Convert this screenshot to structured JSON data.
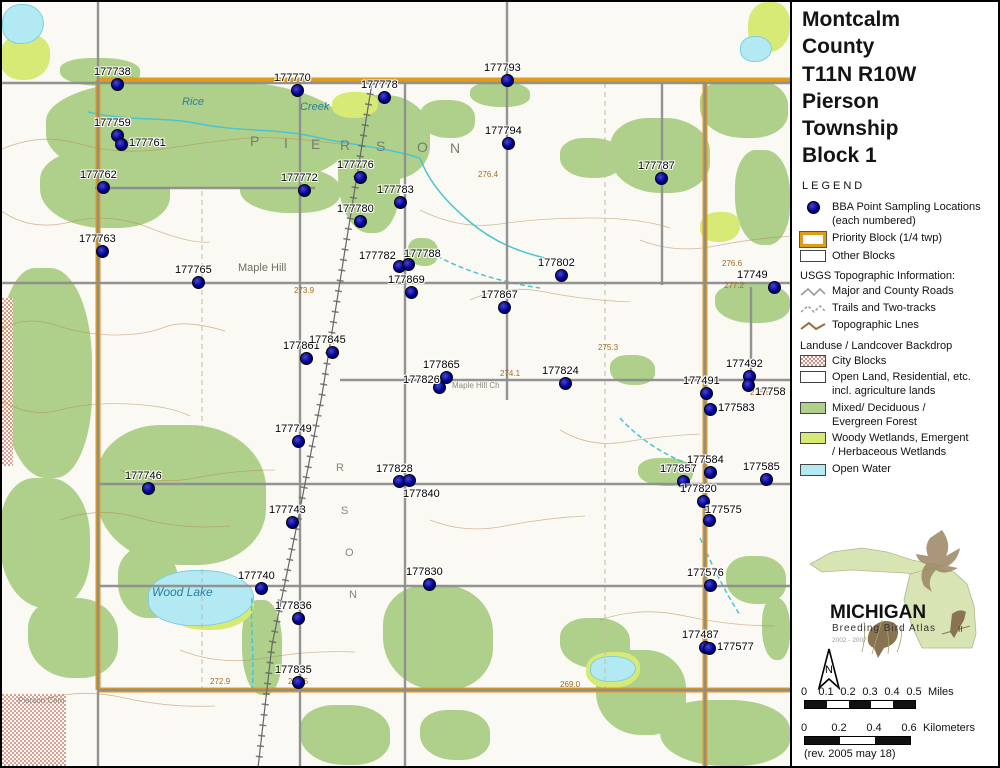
{
  "panel": {
    "title_lines": [
      "Montcalm",
      "County",
      "T11N R10W",
      "Pierson",
      "Township",
      "Block 1"
    ],
    "legend_heading": "LEGEND",
    "legend": {
      "bba_label_1": "BBA Point Sampling Locations",
      "bba_label_2": "(each numbered)",
      "priority_label": "Priority Block (1/4 twp)",
      "other_label": "Other Blocks",
      "usgs_heading": "USGS Topographic Information:",
      "roads_label": "Major and County Roads",
      "trails_label": "Trails and Two-tracks",
      "topo_label": "Topographic Lnes",
      "landuse_heading": "Landuse / Landcover Backdrop",
      "city_label": "City Blocks",
      "open_label_1": "Open Land, Residential, etc.",
      "open_label_2": "incl. agriculture lands",
      "forest_label_1": "Mixed/ Deciduous /",
      "forest_label_2": "Evergreen Forest",
      "wetland_label_1": "Woody Wetlands, Emergent",
      "wetland_label_2": "/ Herbaceous Wetlands",
      "water_label": "Open Water"
    },
    "logo": {
      "name": "MICHIGAN",
      "subtitle": "Breeding Bird Atlas",
      "numeral": "II",
      "years": "2002 - 2007"
    },
    "north_label": "N",
    "scalebars": [
      {
        "ticks": [
          "0",
          "0.1",
          "0.2",
          "0.3",
          "0.4",
          "0.5"
        ],
        "unit": "Miles",
        "segments": 5,
        "segw": 22,
        "top": 686
      },
      {
        "ticks": [
          "0",
          "0.2",
          "0.4",
          "0.6"
        ],
        "unit": "Kilometers",
        "segments": 3,
        "segw": 35,
        "top": 722
      }
    ],
    "rev_note": "(rev. 2005 may 18)"
  },
  "map": {
    "colors": {
      "forest": "#aed08a",
      "wetland": "#d7ea75",
      "water": "#b3e9f2",
      "priority": "#e09b18",
      "road": "#8d8d8d",
      "contour": "#b5854f",
      "creek": "#49c5cf",
      "point": "#000090"
    },
    "points": [
      {
        "id": "177738",
        "x": 117,
        "y": 84,
        "pos": "a"
      },
      {
        "id": "177770",
        "x": 297,
        "y": 90,
        "pos": "a"
      },
      {
        "id": "177778",
        "x": 384,
        "y": 97,
        "pos": "a"
      },
      {
        "id": "177793",
        "x": 507,
        "y": 80,
        "pos": "a"
      },
      {
        "id": "177794",
        "x": 508,
        "y": 143,
        "pos": "a"
      },
      {
        "id": "177787",
        "x": 661,
        "y": 178,
        "pos": "a"
      },
      {
        "id": "177759",
        "x": 117,
        "y": 135,
        "pos": "a"
      },
      {
        "id": "177761",
        "x": 121,
        "y": 144,
        "pos": "r"
      },
      {
        "id": "177762",
        "x": 103,
        "y": 187,
        "pos": "a"
      },
      {
        "id": "177772",
        "x": 304,
        "y": 190,
        "pos": "a"
      },
      {
        "id": "177776",
        "x": 360,
        "y": 177,
        "pos": "a"
      },
      {
        "id": "177783",
        "x": 400,
        "y": 202,
        "pos": "a"
      },
      {
        "id": "177780",
        "x": 360,
        "y": 221,
        "pos": "a"
      },
      {
        "id": "177763",
        "x": 102,
        "y": 251,
        "pos": "a"
      },
      {
        "id": "177765",
        "x": 198,
        "y": 282,
        "pos": "a"
      },
      {
        "id": "177782",
        "x": 399,
        "y": 266,
        "pos": "al"
      },
      {
        "id": "177788",
        "x": 408,
        "y": 264,
        "pos": "ar"
      },
      {
        "id": "177869",
        "x": 411,
        "y": 292,
        "pos": "a"
      },
      {
        "id": "177802",
        "x": 561,
        "y": 275,
        "pos": "a"
      },
      {
        "id": "177867",
        "x": 504,
        "y": 307,
        "pos": "a"
      },
      {
        "id": "17749",
        "x": 774,
        "y": 287,
        "pos": "edge"
      },
      {
        "id": "177861",
        "x": 306,
        "y": 358,
        "pos": "a"
      },
      {
        "id": "177845",
        "x": 332,
        "y": 352,
        "pos": "a"
      },
      {
        "id": "177865",
        "x": 446,
        "y": 377,
        "pos": "a"
      },
      {
        "id": "177826",
        "x": 439,
        "y": 387,
        "pos": "l"
      },
      {
        "id": "177824",
        "x": 565,
        "y": 383,
        "pos": "a"
      },
      {
        "id": "177492",
        "x": 749,
        "y": 376,
        "pos": "a"
      },
      {
        "id": "17758",
        "x": 748,
        "y": 385,
        "pos": "rb"
      },
      {
        "id": "177491",
        "x": 706,
        "y": 393,
        "pos": "a"
      },
      {
        "id": "177583",
        "x": 710,
        "y": 409,
        "pos": "r"
      },
      {
        "id": "177749",
        "x": 298,
        "y": 441,
        "pos": "a"
      },
      {
        "id": "177746",
        "x": 148,
        "y": 488,
        "pos": "a"
      },
      {
        "id": "177828",
        "x": 399,
        "y": 481,
        "pos": "a"
      },
      {
        "id": "177840",
        "x": 409,
        "y": 480,
        "pos": "br"
      },
      {
        "id": "177743",
        "x": 292,
        "y": 522,
        "pos": "a"
      },
      {
        "id": "177857",
        "x": 683,
        "y": 481,
        "pos": "a"
      },
      {
        "id": "177584",
        "x": 710,
        "y": 472,
        "pos": "a"
      },
      {
        "id": "177585",
        "x": 766,
        "y": 479,
        "pos": "a"
      },
      {
        "id": "177820",
        "x": 703,
        "y": 501,
        "pos": "a"
      },
      {
        "id": "177575",
        "x": 709,
        "y": 520,
        "pos": "ar"
      },
      {
        "id": "177740",
        "x": 261,
        "y": 588,
        "pos": "a"
      },
      {
        "id": "177830",
        "x": 429,
        "y": 584,
        "pos": "a"
      },
      {
        "id": "177836",
        "x": 298,
        "y": 618,
        "pos": "a"
      },
      {
        "id": "177576",
        "x": 710,
        "y": 585,
        "pos": "a"
      },
      {
        "id": "177487",
        "x": 705,
        "y": 647,
        "pos": "a"
      },
      {
        "id": "177577",
        "x": 709,
        "y": 648,
        "pos": "r"
      },
      {
        "id": "177835",
        "x": 298,
        "y": 682,
        "pos": "a"
      }
    ],
    "place_labels": [
      {
        "t": "Rice",
        "x": 182,
        "y": 96,
        "cls": "water"
      },
      {
        "t": "Creek",
        "x": 300,
        "y": 101,
        "cls": "water"
      },
      {
        "t": "P",
        "x": 250,
        "y": 133,
        "cls": "twp"
      },
      {
        "t": "I",
        "x": 284,
        "y": 135,
        "cls": "twp"
      },
      {
        "t": "E",
        "x": 311,
        "y": 136,
        "cls": "twp"
      },
      {
        "t": "R",
        "x": 340,
        "y": 137,
        "cls": "twp"
      },
      {
        "t": "S",
        "x": 376,
        "y": 138,
        "cls": "twp"
      },
      {
        "t": "O",
        "x": 417,
        "y": 139,
        "cls": "twp"
      },
      {
        "t": "N",
        "x": 450,
        "y": 140,
        "cls": "twp"
      },
      {
        "t": "Maple Hill",
        "x": 238,
        "y": 262,
        "cls": "place"
      },
      {
        "t": "Maple Hill Ch",
        "x": 452,
        "y": 381,
        "cls": "tiny"
      },
      {
        "t": "Wood Lake",
        "x": 152,
        "y": 585,
        "cls": "water-i"
      },
      {
        "t": "Pierson Cem",
        "x": 18,
        "y": 696,
        "cls": "tiny"
      },
      {
        "t": "R",
        "x": 336,
        "y": 462,
        "cls": "twp2"
      },
      {
        "t": "S",
        "x": 341,
        "y": 505,
        "cls": "twp2"
      },
      {
        "t": "O",
        "x": 345,
        "y": 547,
        "cls": "twp2"
      },
      {
        "t": "N",
        "x": 349,
        "y": 589,
        "cls": "twp2"
      }
    ],
    "elev_labels": [
      {
        "t": "276.6",
        "x": 722,
        "y": 259
      },
      {
        "t": "277.2",
        "x": 724,
        "y": 281
      },
      {
        "t": "276.5",
        "x": 750,
        "y": 388
      },
      {
        "t": "274.1",
        "x": 500,
        "y": 369
      },
      {
        "t": "273.9",
        "x": 294,
        "y": 286
      },
      {
        "t": "276.4",
        "x": 478,
        "y": 170
      },
      {
        "t": "275.3",
        "x": 598,
        "y": 343
      },
      {
        "t": "272.9",
        "x": 210,
        "y": 677
      },
      {
        "t": "271.5",
        "x": 288,
        "y": 677
      },
      {
        "t": "269.0",
        "x": 560,
        "y": 680
      }
    ],
    "backdrop": {
      "forest": [
        [
          46,
          80,
          300,
          108
        ],
        [
          60,
          58,
          80,
          28
        ],
        [
          330,
          95,
          100,
          85
        ],
        [
          40,
          150,
          130,
          78
        ],
        [
          338,
          118,
          62,
          115
        ],
        [
          420,
          100,
          55,
          38
        ],
        [
          470,
          82,
          60,
          25
        ],
        [
          560,
          138,
          62,
          40
        ],
        [
          610,
          118,
          100,
          75
        ],
        [
          700,
          78,
          88,
          60
        ],
        [
          735,
          150,
          55,
          95
        ],
        [
          715,
          283,
          75,
          40
        ],
        [
          0,
          268,
          92,
          210
        ],
        [
          96,
          425,
          170,
          140
        ],
        [
          0,
          478,
          90,
          130
        ],
        [
          28,
          598,
          90,
          80
        ],
        [
          118,
          548,
          60,
          70
        ],
        [
          242,
          600,
          40,
          95
        ],
        [
          383,
          585,
          110,
          105
        ],
        [
          560,
          618,
          70,
          50
        ],
        [
          596,
          650,
          90,
          85
        ],
        [
          660,
          700,
          130,
          66
        ],
        [
          300,
          705,
          90,
          60
        ],
        [
          420,
          710,
          70,
          50
        ],
        [
          726,
          556,
          60,
          48
        ],
        [
          762,
          598,
          28,
          62
        ],
        [
          408,
          238,
          30,
          28
        ],
        [
          610,
          355,
          45,
          30
        ],
        [
          638,
          458,
          55,
          28
        ],
        [
          240,
          168,
          100,
          45
        ]
      ],
      "wetland": [
        [
          748,
          2,
          42,
          50
        ],
        [
          0,
          34,
          50,
          46
        ],
        [
          332,
          92,
          46,
          26
        ],
        [
          700,
          212,
          40,
          30
        ],
        [
          168,
          580,
          86,
          50
        ],
        [
          586,
          652,
          54,
          36
        ]
      ],
      "water": [
        [
          2,
          4,
          40,
          38
        ],
        [
          740,
          36,
          30,
          24
        ],
        [
          148,
          570,
          104,
          54
        ],
        [
          590,
          656,
          44,
          24
        ]
      ],
      "city": [
        [
          0,
          298,
          13,
          168
        ],
        [
          0,
          694,
          66,
          72
        ]
      ],
      "roads_gray": [
        [
          0,
          83,
          790,
          83
        ],
        [
          95,
          188,
          315,
          188
        ],
        [
          0,
          283,
          790,
          283
        ],
        [
          340,
          380,
          790,
          380
        ],
        [
          98,
          484,
          790,
          484
        ],
        [
          98,
          586,
          790,
          586
        ],
        [
          98,
          690,
          790,
          690
        ],
        [
          98,
          0,
          98,
          768
        ],
        [
          300,
          83,
          300,
          768
        ],
        [
          405,
          83,
          405,
          768
        ],
        [
          507,
          0,
          507,
          400
        ],
        [
          662,
          83,
          662,
          285
        ],
        [
          705,
          83,
          705,
          768
        ],
        [
          751,
          287,
          751,
          380
        ]
      ],
      "roads_orange": [
        [
          98,
          80,
          790,
          80
        ],
        [
          98,
          690,
          790,
          690
        ],
        [
          98,
          80,
          98,
          690
        ],
        [
          705,
          80,
          705,
          768
        ]
      ],
      "section_lines": [
        [
          202,
          83,
          202,
          690
        ],
        [
          605,
          83,
          605,
          690
        ]
      ],
      "railroad": "M372,83 L345,250 L322,395 L298,520 L272,645 L258,768",
      "creeks": [
        "M88,112 C130,122 160,116 200,124 C240,132 280,128 320,138 C350,145 380,146 420,158",
        "M420,158 C430,185 450,205 470,222 C495,243 520,252 545,258",
        "M430,252 C460,270 500,282 540,288",
        "M620,418 C640,440 665,455 690,465",
        "M700,538 C712,565 725,592 740,615",
        "M252,598 C250,630 255,660 252,690"
      ],
      "contours": [
        "M0,150 q40,-18 80,-6 t90,4 t80,-10 t90,6",
        "M0,210 q30,22 70,12 t80,6 t60,14",
        "M0,330 q25,-15 55,-5 t60,10 t50,-8 t60,4",
        "M0,400 q30,18 60,10 t70,-6 t60,12",
        "M60,520 q40,-14 80,-2 t90,8",
        "M120,470 q35,16 75,8 t80,-8",
        "M420,210 q40,20 80,14 t90,-6 t80,10",
        "M470,300 q35,-16 75,-8 t85,10",
        "M560,430 q30,18 65,12 t75,-8",
        "M600,620 q40,-14 85,-4 t90,10",
        "M640,240 q35,14 75,6 t80,-10",
        "M180,650 q40,16 85,8 t90,-6",
        "M40,700 q40,-12 85,-2 t90,8",
        "M430,520 q35,14 75,6 t80,-10"
      ]
    }
  }
}
